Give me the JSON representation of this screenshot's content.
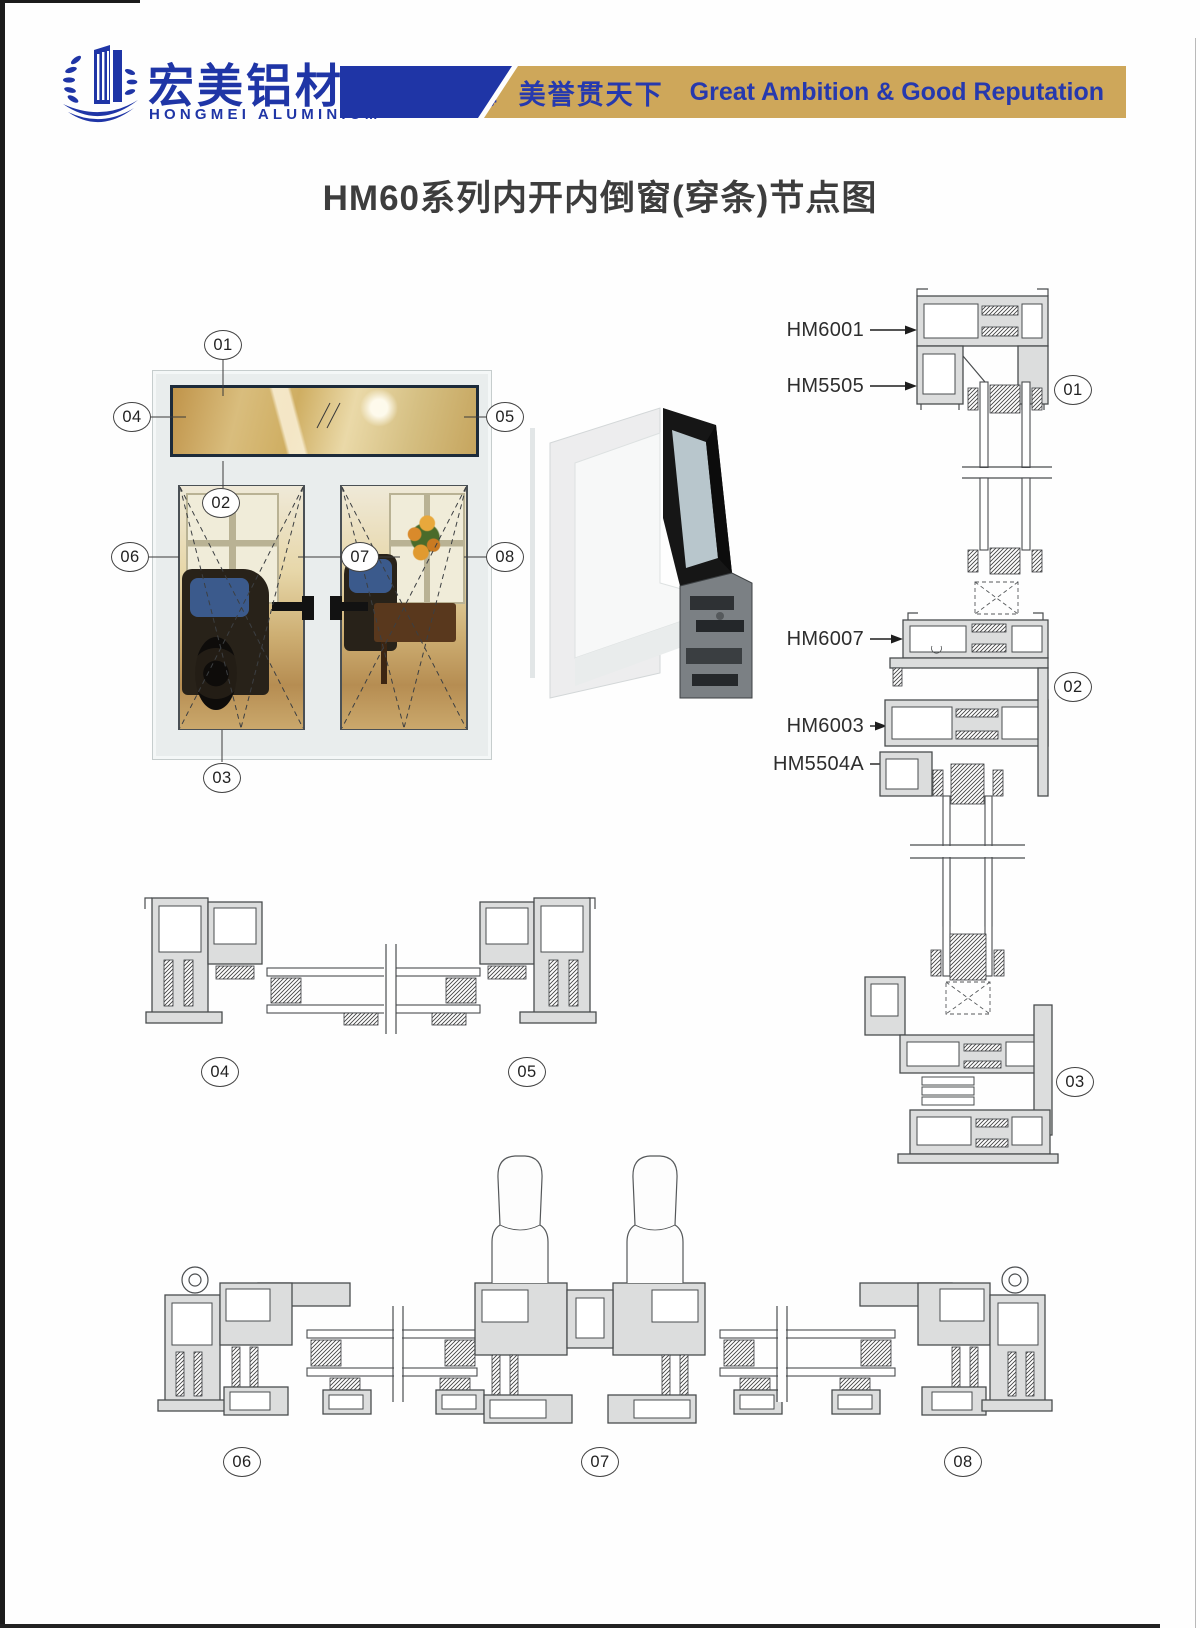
{
  "page_title": "HM60系列内开内倒窗(穿条)节点图",
  "header": {
    "brand_cn": "宏美铝材",
    "reg_mark": "®",
    "brand_en": "HONGMEI ALUMINIUM",
    "slogan_cn": "宏图筑四海  美誉贯天下",
    "slogan_en": "Great Ambition & Good Reputation"
  },
  "colors": {
    "brand_blue": "#1F35A6",
    "banner_gold": "#CEA75A",
    "slogan_text_blue": "#2639AE",
    "title_gray": "#3D3D3D"
  },
  "profile_labels": [
    {
      "text": "HM6001",
      "y": 330
    },
    {
      "text": "HM5505",
      "y": 386
    },
    {
      "text": "HM6007",
      "y": 639
    },
    {
      "text": "HM6003",
      "y": 726
    },
    {
      "text": "HM5504A",
      "y": 764
    }
  ],
  "callouts": [
    {
      "id": "01",
      "group": "elevation",
      "x": 223,
      "y": 345
    },
    {
      "id": "02",
      "group": "elevation",
      "x": 221,
      "y": 503
    },
    {
      "id": "03",
      "group": "elevation",
      "x": 222,
      "y": 778
    },
    {
      "id": "04",
      "group": "elevation",
      "x": 132,
      "y": 417
    },
    {
      "id": "05",
      "group": "elevation",
      "x": 505,
      "y": 417
    },
    {
      "id": "06",
      "group": "elevation",
      "x": 130,
      "y": 557
    },
    {
      "id": "07",
      "group": "elevation",
      "x": 360,
      "y": 557
    },
    {
      "id": "08",
      "group": "elevation",
      "x": 505,
      "y": 557
    },
    {
      "id": "01",
      "group": "vertical-section",
      "x": 1073,
      "y": 390
    },
    {
      "id": "02",
      "group": "vertical-section",
      "x": 1073,
      "y": 687
    },
    {
      "id": "03",
      "group": "vertical-section",
      "x": 1075,
      "y": 1082
    },
    {
      "id": "04",
      "group": "horizontal-section",
      "x": 220,
      "y": 1072
    },
    {
      "id": "05",
      "group": "horizontal-section",
      "x": 527,
      "y": 1072
    },
    {
      "id": "06",
      "group": "meeting-stile-section",
      "x": 242,
      "y": 1462
    },
    {
      "id": "07",
      "group": "meeting-stile-section",
      "x": 600,
      "y": 1462
    },
    {
      "id": "08",
      "group": "meeting-stile-section",
      "x": 963,
      "y": 1462
    }
  ]
}
